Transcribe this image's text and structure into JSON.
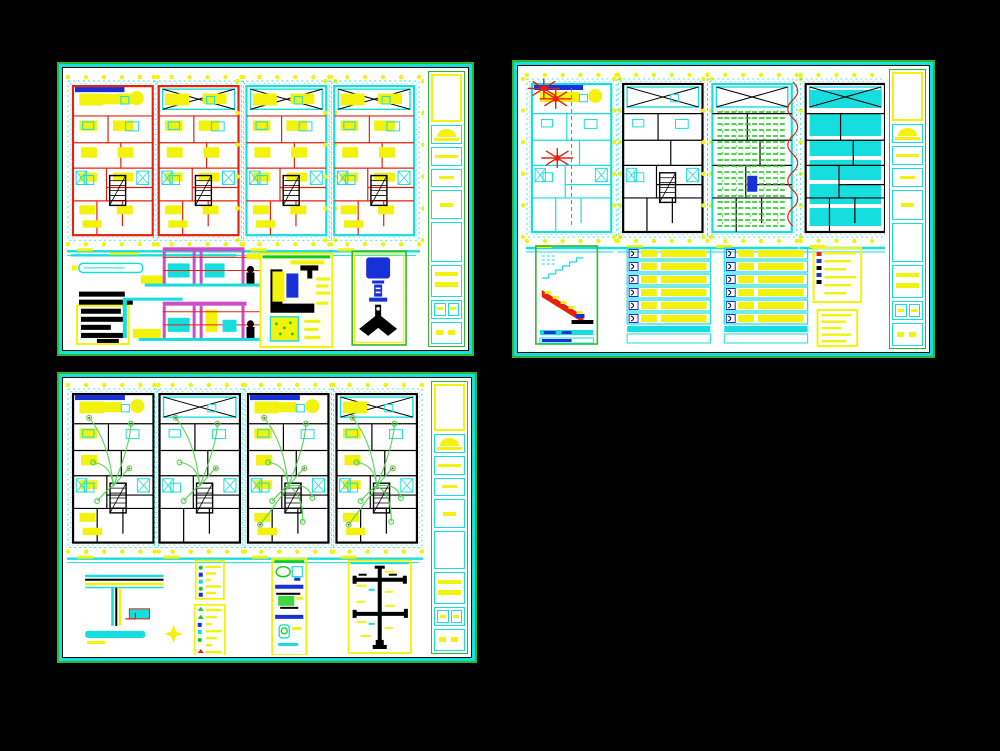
{
  "page": {
    "background": "#000000",
    "description": "Three CAD architectural drawing sheets (plans, details, schedules) on a black model-space background"
  },
  "palette": {
    "paper": "#ffffff",
    "green": "#2eb82e",
    "bright_green": "#10cc10",
    "wire_green": "#55d455",
    "cyan": "#17dede",
    "yellow": "#f2f20c",
    "red": "#e8200e",
    "blue": "#1730d8",
    "magenta": "#c94fc9",
    "ink": "#000000"
  },
  "sheets": [
    {
      "id": "sheet-1",
      "name": "architectural-floor-plans-sheet",
      "position": "top-left",
      "title_block_cells": 9,
      "plans": [
        {
          "name": "floor-plan-1",
          "walls": "red",
          "partitions": "red",
          "fills": "yellow",
          "brace": false,
          "stair": true,
          "overlay": "none",
          "side_bubbles": false
        },
        {
          "name": "floor-plan-2",
          "walls": "red",
          "partitions": "red",
          "fills": "yellow",
          "brace": true,
          "stair": true,
          "overlay": "none",
          "side_bubbles": false
        },
        {
          "name": "floor-plan-3",
          "walls": "cyan",
          "partitions": "red",
          "fills": "yellow",
          "brace": true,
          "stair": true,
          "overlay": "none",
          "side_bubbles": true
        },
        {
          "name": "floor-plan-4",
          "walls": "cyan",
          "partitions": "red",
          "fills": "yellow",
          "brace": true,
          "stair": true,
          "overlay": "none",
          "side_bubbles": true
        }
      ],
      "details": [
        "schedule-text-block",
        "beam-detail",
        "front-elevation",
        "rear-elevation",
        "wall-section-detail",
        "roof-finial-detail"
      ]
    },
    {
      "id": "sheet-2",
      "name": "structure-and-schedules-sheet",
      "position": "top-right",
      "title_block_cells": 9,
      "plans": [
        {
          "name": "services-plan",
          "walls": "cyan",
          "partitions": "cyan",
          "fills": "none",
          "brace": false,
          "stair": false,
          "overlay": "bursts",
          "side_bubbles": true
        },
        {
          "name": "walls-plan",
          "walls": "ink",
          "partitions": "ink",
          "fills": "none",
          "brace": true,
          "stair": true,
          "overlay": "none",
          "side_bubbles": true
        },
        {
          "name": "joist-framing-plan",
          "walls": "cyan",
          "partitions": "ink",
          "fills": "none",
          "brace": true,
          "stair": false,
          "overlay": "hatch",
          "side_bubbles": true
        },
        {
          "name": "ceiling-finish-plan",
          "walls": "ink",
          "partitions": "ink",
          "fills": "none",
          "brace": true,
          "stair": false,
          "overlay": "cyan-rooms",
          "break_line": true,
          "side_bubbles": false
        }
      ],
      "schedules": [
        {
          "name": "door-window-schedule-a",
          "rows": 6
        },
        {
          "name": "door-window-schedule-b",
          "rows": 6
        }
      ],
      "notes": [
        {
          "name": "general-notes-a",
          "lines": 6
        },
        {
          "name": "general-notes-b",
          "lines": 5
        }
      ],
      "details": [
        "stair-section-detail"
      ]
    },
    {
      "id": "sheet-3",
      "name": "electrical-plans-sheet",
      "position": "bottom-left",
      "title_block_cells": 9,
      "plans": [
        {
          "name": "electrical-plan-1",
          "walls": "ink",
          "partitions": "ink",
          "fills": "yellow",
          "sparse": true,
          "brace": false,
          "stair": true,
          "overlay": "wiring",
          "wires": 5,
          "side_bubbles": false
        },
        {
          "name": "electrical-plan-2",
          "walls": "ink",
          "partitions": "ink",
          "fills": "none",
          "brace": true,
          "stair": true,
          "overlay": "wiring",
          "wires": 5,
          "side_bubbles": false
        },
        {
          "name": "electrical-plan-3",
          "walls": "ink",
          "partitions": "ink",
          "fills": "yellow",
          "sparse": true,
          "brace": false,
          "stair": true,
          "overlay": "wiring",
          "wires": 8,
          "side_bubbles": false
        },
        {
          "name": "electrical-plan-4",
          "walls": "ink",
          "partitions": "ink",
          "fills": "yellow",
          "sparse": true,
          "brace": true,
          "stair": true,
          "overlay": "wiring",
          "wires": 8,
          "side_bubbles": false
        }
      ],
      "legends": [
        {
          "name": "symbol-legend-a",
          "lines": 5
        },
        {
          "name": "symbol-legend-b",
          "lines": 7
        }
      ],
      "details": [
        "roof-edge-section-detail",
        "plumbing-fixtures-detail",
        "electrical-riser-diagram"
      ]
    }
  ]
}
